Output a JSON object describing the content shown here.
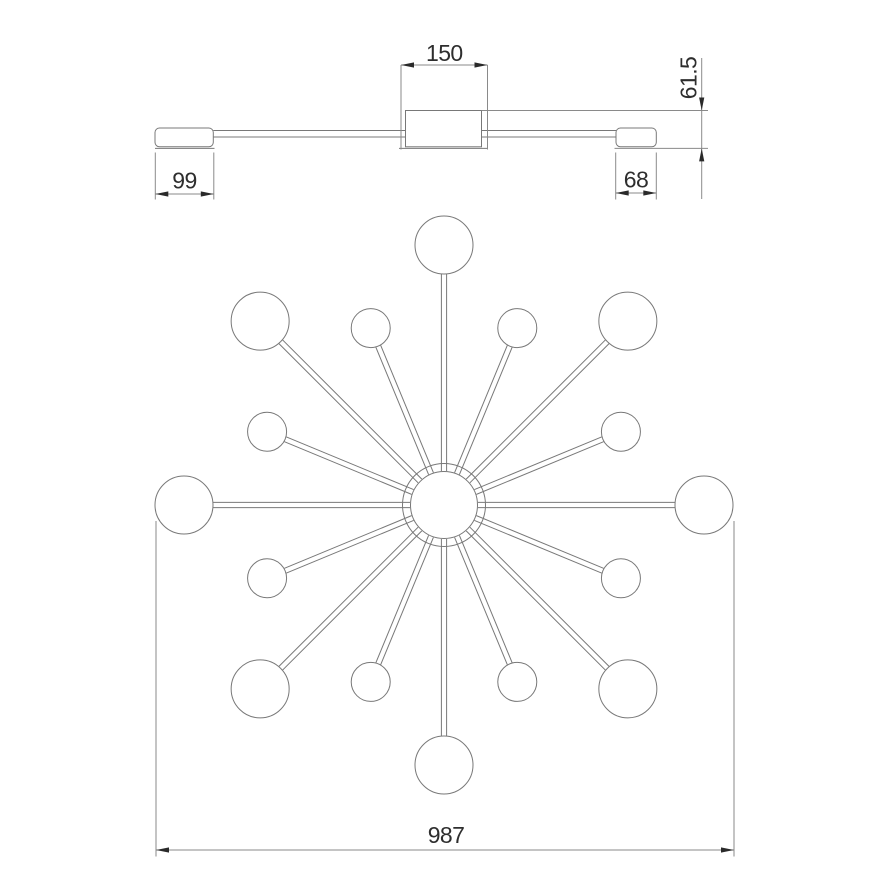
{
  "drawing": {
    "type": "technical dimension drawing of a 16-arm sputnik ceiling chandelier (side view on top, plan view below)",
    "labels": {
      "canopy_width": "150",
      "fixture_height": "61.5",
      "large_shade_width": "99",
      "small_shade_width": "68",
      "overall_diameter": "987"
    },
    "colors": {
      "background": "#ffffff",
      "object_line": "#787878",
      "dimension_line": "#8a8a8a",
      "arrow": "#2a2a2a",
      "text": "#2e2e2e"
    },
    "starburst": {
      "center_x": 444,
      "center_y": 505,
      "hub_outer_radius": 41.5,
      "hub_inner_radius": 33.5,
      "arm_count": 16,
      "arm_step_degrees": 22.5,
      "arm_inner_radius": 34,
      "arm_half_width": 2.6,
      "large_bulb": {
        "distance": 260,
        "radius": 29
      },
      "small_bulb": {
        "distance": 191.5,
        "radius": 19.5
      }
    }
  }
}
